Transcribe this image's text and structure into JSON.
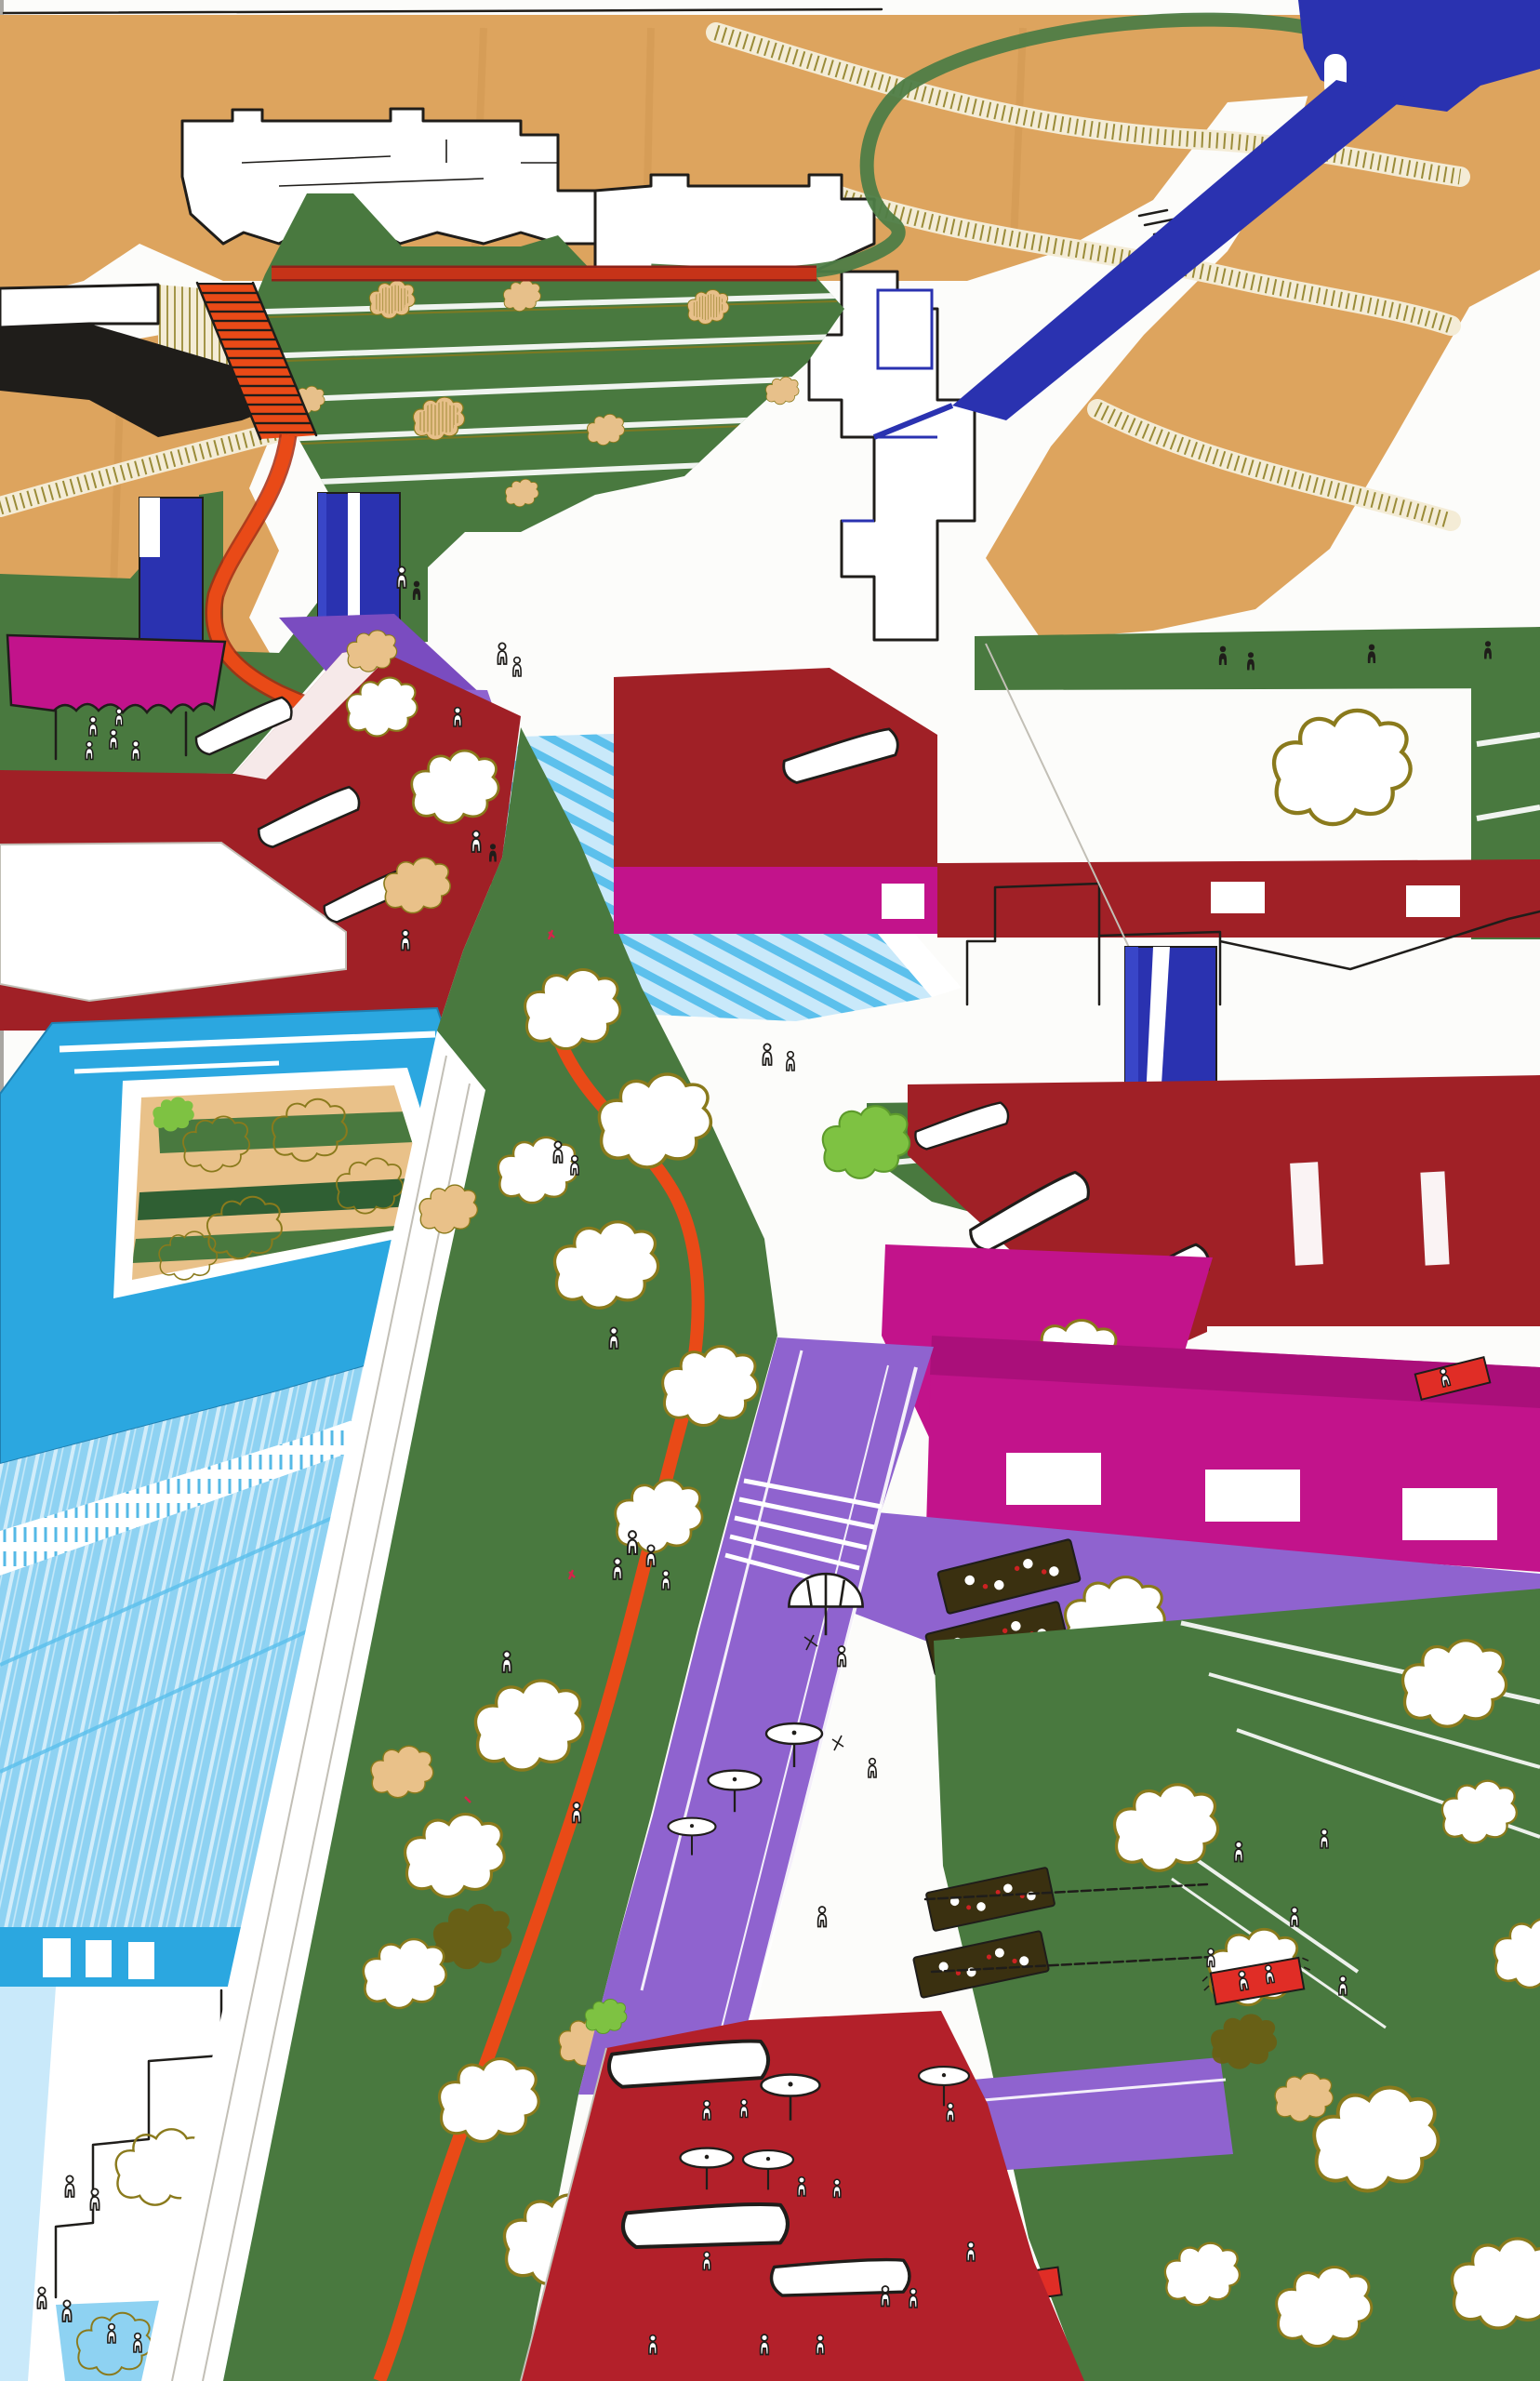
{
  "alt": "Hand-drawn marker and ink aerial perspective sketch of an urban masterplan: an orange pedestrian promenade starts with stairs on a tan hillside at top left, winds down through green terraced parks and tree-dotted lawns, past navy towers, a magenta canopy, cyan courtyard buildings and light-blue roofs, a purple pedestrian mall with white umbrellas and trellis tables, magenta and dark-red halls, ending at a red event plaza with canopies; tiny stick figures, picnic blankets and a green loop road with a navy ramp complete the scene.",
  "image": {
    "kind": "architectural perspective sketch",
    "medium": "marker and ink on paper"
  },
  "palette": {
    "paper": "#fcfcfa",
    "ink": "#1f1d1a",
    "pencil": "#c2bfb6",
    "tan": "#dda45e",
    "tan_light": "#e9c189",
    "cream": "#f4ecd6",
    "olive": "#8a7a1c",
    "olive_dark": "#6b5e12",
    "green": "#49793f",
    "green_dark": "#2f5f33",
    "lime": "#7ec242",
    "orange": "#e94a17",
    "red_path": "#c63318",
    "crimson": "#a02026",
    "red_plaza": "#b3202a",
    "red_bright": "#e02d26",
    "magenta": "#c2138b",
    "magenta_deep": "#9c0e72",
    "purple": "#8f63cf",
    "purple_deep": "#7a4cc0",
    "navy": "#2a32b0",
    "royal": "#3946c8",
    "cyan": "#2ba7e0",
    "cyan_light": "#8ed2f2",
    "cyan_pale": "#c9e9fa",
    "sky": "#5bc0ec"
  },
  "elements": [
    {
      "name": "hillside",
      "color": "tan",
      "note": "marker-hatched slope with contour ribbons, top of sheet"
    },
    {
      "name": "hill-buildings",
      "color": "paper",
      "note": "white crenellated building outlines on the hill"
    },
    {
      "name": "terraced-park",
      "color": "green",
      "note": "stepped green terraces with tan shrubs"
    },
    {
      "name": "promenade",
      "color": "orange",
      "note": "winding pedestrian route with a stair flight, top-left to bottom"
    },
    {
      "name": "loop-road",
      "color": "green",
      "note": "curving green road at top right"
    },
    {
      "name": "ramp",
      "color": "navy",
      "note": "diagonal blue access ramp from top-right corner"
    },
    {
      "name": "towers",
      "color": "navy",
      "note": "three blue tower slabs"
    },
    {
      "name": "market-canopy",
      "color": "magenta",
      "note": "scalloped canopy at left with figures below"
    },
    {
      "name": "upper-ramps",
      "color": "purple",
      "note": "purple ramp planes near second tower"
    },
    {
      "name": "terraced-steps",
      "color": "cyan_pale",
      "note": "wide cyan amphitheater steps"
    },
    {
      "name": "red-halls",
      "color": "crimson",
      "note": "dark red building complexes left and right with white roof canopies"
    },
    {
      "name": "courtyard-building",
      "color": "cyan",
      "note": "cyan ring building with planted courtyard"
    },
    {
      "name": "lightblue-roofs",
      "color": "cyan_light",
      "note": "long streaked roofs with scalloped awnings, bottom left"
    },
    {
      "name": "central-lawn",
      "color": "green",
      "note": "tree-dotted lawn with stick figures"
    },
    {
      "name": "pedestrian-mall",
      "color": "purple",
      "note": "purple mall with umbrellas, trellis tables and steps"
    },
    {
      "name": "magenta-facade",
      "color": "magenta",
      "note": "long magenta building band with white windows"
    },
    {
      "name": "right-lawn",
      "color": "green",
      "note": "large lawn with white mown stripes and picnic blankets"
    },
    {
      "name": "event-plaza",
      "color": "red_plaza",
      "note": "red plaza with white canopies, umbrellas and many figures"
    }
  ],
  "counts": {
    "stick_figures": 68,
    "white_trees": 27,
    "tan_shrubs": 14,
    "round_umbrellas": 8,
    "canopy_roofs": 10,
    "trellis_tables": 4,
    "picnic_blankets": 3,
    "towers": 3
  }
}
